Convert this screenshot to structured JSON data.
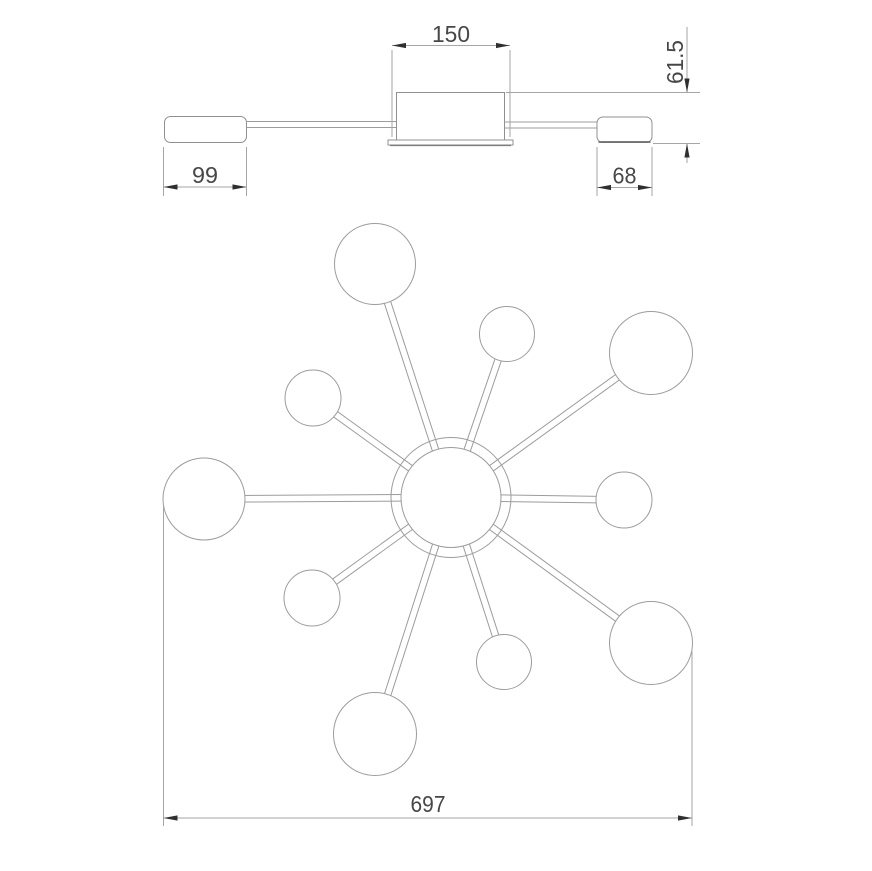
{
  "side_view": {
    "dim_center_width": "150",
    "dim_height": "61.5",
    "dim_left_cap_width": "99",
    "dim_right_cap_width": "68"
  },
  "plan_view": {
    "dim_total_width": "697",
    "hub": {
      "cx": 451,
      "cy": 497.5,
      "r_inner": 50,
      "r_outer": 60
    },
    "spoke_half_gap": 3.3,
    "satellites": [
      {
        "cx": 375,
        "cy": 264,
        "r": 40.5
      },
      {
        "cx": 507,
        "cy": 334,
        "r": 27.5
      },
      {
        "cx": 313,
        "cy": 398,
        "r": 28
      },
      {
        "cx": 651,
        "cy": 353,
        "r": 41.5
      },
      {
        "cx": 204,
        "cy": 499,
        "r": 41
      },
      {
        "cx": 624,
        "cy": 500,
        "r": 28
      },
      {
        "cx": 312,
        "cy": 598,
        "r": 28
      },
      {
        "cx": 651,
        "cy": 643,
        "r": 41.5
      },
      {
        "cx": 504,
        "cy": 662,
        "r": 27.5
      },
      {
        "cx": 375,
        "cy": 734,
        "r": 41.5
      }
    ]
  },
  "colors": {
    "line": "#9c9c9c",
    "dim_line": "#a6a6a6",
    "dark_edge": "#6b6b6b",
    "text": "#474747",
    "arrow": "#2f2f2f",
    "background": "#ffffff"
  }
}
